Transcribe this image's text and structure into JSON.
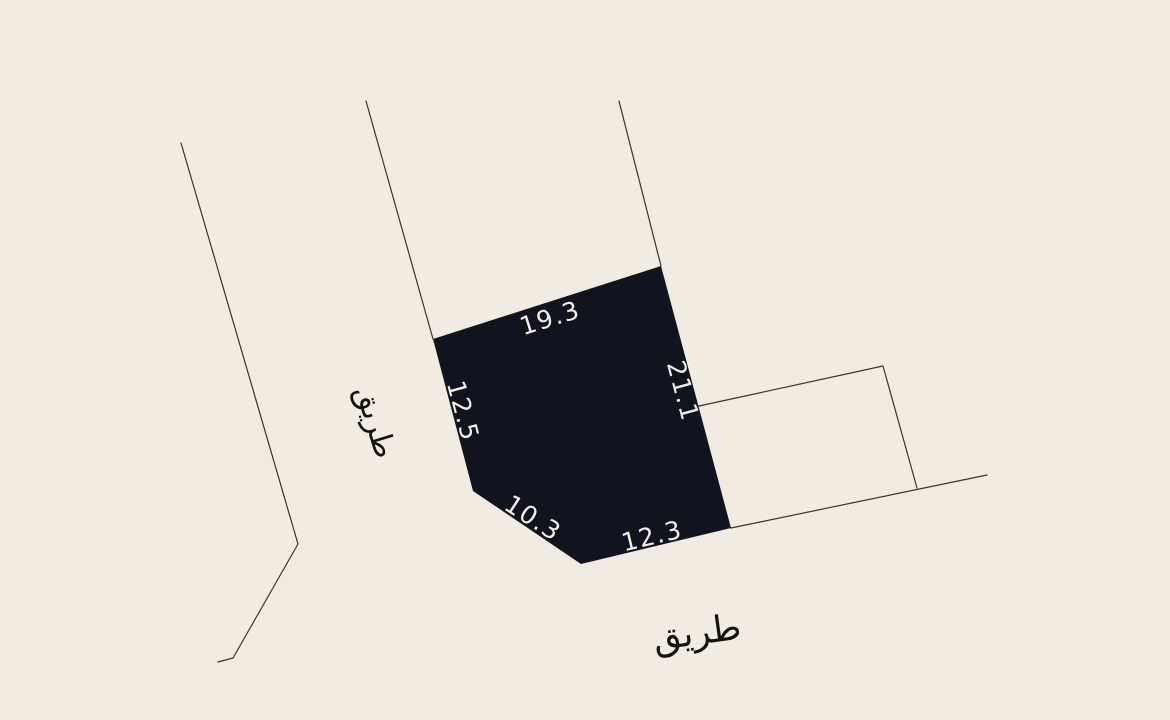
{
  "colors": {
    "background": "#f0ece4",
    "parcel_fill": "#12141d",
    "dimension_text": "#f2eee6",
    "boundary_line": "#39352d",
    "road_text": "#15130e"
  },
  "map": {
    "parcel": {
      "points": "433,339 661,266 731,528 581,564 473,491"
    },
    "dimension_labels": [
      {
        "value": "19.3",
        "x": 550,
        "y": 318,
        "angle": -17.5
      },
      {
        "value": "21.1",
        "x": 683,
        "y": 391,
        "angle": 75
      },
      {
        "value": "12.5",
        "x": 463,
        "y": 411,
        "angle": 75
      },
      {
        "value": "10.3",
        "x": 533,
        "y": 518,
        "angle": 33
      },
      {
        "value": "12.3",
        "x": 652,
        "y": 536,
        "angle": -13.5
      }
    ],
    "boundary_lines": [
      {
        "points": "181,143 298,544 233,658 218,662"
      },
      {
        "points": "366,101 433,339"
      },
      {
        "points": "619,101 661,266"
      },
      {
        "points": "699,406 883,366 917,488"
      },
      {
        "points": "731,528 987,475"
      }
    ],
    "road_labels": [
      {
        "value": "طريق",
        "x": 375,
        "y": 422,
        "angle": 73,
        "font_size": 30
      },
      {
        "value": "طريق",
        "x": 697,
        "y": 633,
        "angle": -8,
        "font_size": 36
      }
    ]
  }
}
